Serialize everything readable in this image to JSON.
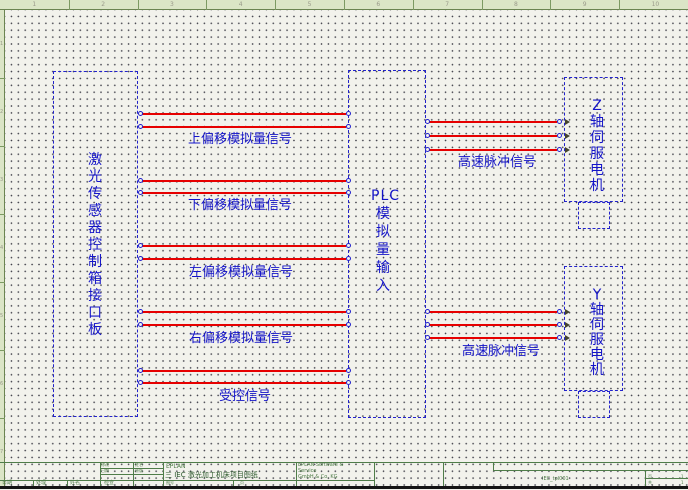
{
  "sheet": {
    "width": 688,
    "height": 490,
    "colors": {
      "background": "#f2f2ec",
      "grid_dot": "#3c3c46",
      "ruler_fill": "#dbe5c6",
      "ruler_line": "#7c9a62",
      "box_border_blue": "#2222cc",
      "schematic_text_blue": "#1414c8",
      "wire_red": "#e60000",
      "titleblock_green": "#4f7d49"
    },
    "top_ruler_numbers": [
      "1",
      "2",
      "3",
      "4",
      "5",
      "6",
      "7",
      "8",
      "9",
      "10"
    ],
    "left_ruler_numbers": [
      "1",
      "2",
      "3",
      "4",
      "5",
      "6",
      "7"
    ]
  },
  "schematic": {
    "boxes": [
      {
        "id": "laser-sensor-interface-board",
        "x": 53,
        "y": 71,
        "w": 85,
        "h": 346,
        "vtext": "激光传感器控制箱接口板",
        "tx": 95,
        "ty": 152,
        "lh": 17
      },
      {
        "id": "plc-analog-input",
        "x": 348,
        "y": 70,
        "w": 78,
        "h": 348,
        "htext": "PLC",
        "hx": 371,
        "hy": 189,
        "vtext": "模拟量输入",
        "tx": 383,
        "ty": 205,
        "lh": 18
      },
      {
        "id": "z-axis-servo-motor",
        "x": 564,
        "y": 77,
        "w": 59,
        "h": 125,
        "vtext": "Z轴伺服电机",
        "tx": 597,
        "ty": 98,
        "lh": 16
      },
      {
        "id": "z-axis-servo-connector",
        "x": 578,
        "y": 202,
        "w": 32,
        "h": 27
      },
      {
        "id": "y-axis-servo-motor",
        "x": 564,
        "y": 266,
        "w": 59,
        "h": 125,
        "vtext": "Y轴伺服电机",
        "tx": 597,
        "ty": 288,
        "lh": 15
      },
      {
        "id": "y-axis-servo-connector",
        "x": 578,
        "y": 391,
        "w": 32,
        "h": 27
      }
    ],
    "wires": [
      {
        "x1": 142,
        "x2": 346,
        "y": 114
      },
      {
        "x1": 142,
        "x2": 346,
        "y": 127
      },
      {
        "x1": 142,
        "x2": 346,
        "y": 181
      },
      {
        "x1": 142,
        "x2": 346,
        "y": 193
      },
      {
        "x1": 142,
        "x2": 346,
        "y": 246
      },
      {
        "x1": 142,
        "x2": 346,
        "y": 259
      },
      {
        "x1": 142,
        "x2": 346,
        "y": 312
      },
      {
        "x1": 142,
        "x2": 346,
        "y": 325
      },
      {
        "x1": 142,
        "x2": 346,
        "y": 371
      },
      {
        "x1": 142,
        "x2": 346,
        "y": 383
      },
      {
        "x1": 429,
        "x2": 557,
        "y": 122,
        "arrow": true
      },
      {
        "x1": 429,
        "x2": 557,
        "y": 136,
        "arrow": true
      },
      {
        "x1": 429,
        "x2": 557,
        "y": 150,
        "arrow": true
      },
      {
        "x1": 429,
        "x2": 557,
        "y": 312,
        "arrow": true
      },
      {
        "x1": 429,
        "x2": 557,
        "y": 325,
        "arrow": true
      },
      {
        "x1": 429,
        "x2": 557,
        "y": 338,
        "arrow": true
      }
    ],
    "net_labels": [
      {
        "text": "上偏移模拟量信号",
        "x": 240,
        "y": 140
      },
      {
        "text": "下偏移模拟量信号",
        "x": 240,
        "y": 206
      },
      {
        "text": "左偏移模拟量信号",
        "x": 241,
        "y": 273
      },
      {
        "text": "右偏移模拟量信号",
        "x": 241,
        "y": 339
      },
      {
        "text": "受控信号",
        "x": 245,
        "y": 397
      },
      {
        "text": "高速脉冲信号",
        "x": 497,
        "y": 163
      },
      {
        "text": "高速脉冲信号",
        "x": 501,
        "y": 352
      }
    ]
  },
  "title_block": {
    "small_texts": [
      {
        "t": "日期",
        "x": 2,
        "y": 19,
        "s": 5
      },
      {
        "t": "处理",
        "x": 36,
        "y": 19,
        "s": 5
      },
      {
        "t": "姓名",
        "x": 70,
        "y": 19,
        "s": 5
      },
      {
        "t": "检查",
        "x": 104,
        "y": 19,
        "s": 5
      },
      {
        "t": "修改",
        "x": 101,
        "y": 1,
        "s": 4
      },
      {
        "t": "日期",
        "x": 101,
        "y": 7,
        "s": 4
      },
      {
        "t": "姓名",
        "x": 135,
        "y": 1,
        "s": 4
      },
      {
        "t": "原版",
        "x": 135,
        "y": 7,
        "s": 4
      },
      {
        "t": "EPLAN",
        "x": 166,
        "y": 2,
        "s": 6
      },
      {
        "t": "三 IEC 激光加工机床项目图纸",
        "x": 165,
        "y": 10,
        "s": 7,
        "c": "#2d5a2d"
      },
      {
        "t": "图号",
        "x": 166,
        "y": 19,
        "s": 4
      },
      {
        "t": "页",
        "x": 240,
        "y": 19,
        "s": 4
      },
      {
        "t": "EPLAN Software &",
        "x": 298,
        "y": 1,
        "s": 5
      },
      {
        "t": "Service",
        "x": 298,
        "y": 7,
        "s": 5
      },
      {
        "t": "GmbH & Co. KG",
        "x": 298,
        "y": 13,
        "s": 5
      },
      {
        "t": "IEC_tpl001",
        "x": 542,
        "y": 15,
        "s": 5
      },
      {
        "t": "页",
        "x": 648,
        "y": 13,
        "s": 4
      },
      {
        "t": "1",
        "x": 681,
        "y": 13,
        "s": 4
      },
      {
        "t": "共",
        "x": 648,
        "y": 19,
        "s": 4
      },
      {
        "t": "1",
        "x": 681,
        "y": 19,
        "s": 4
      }
    ]
  }
}
